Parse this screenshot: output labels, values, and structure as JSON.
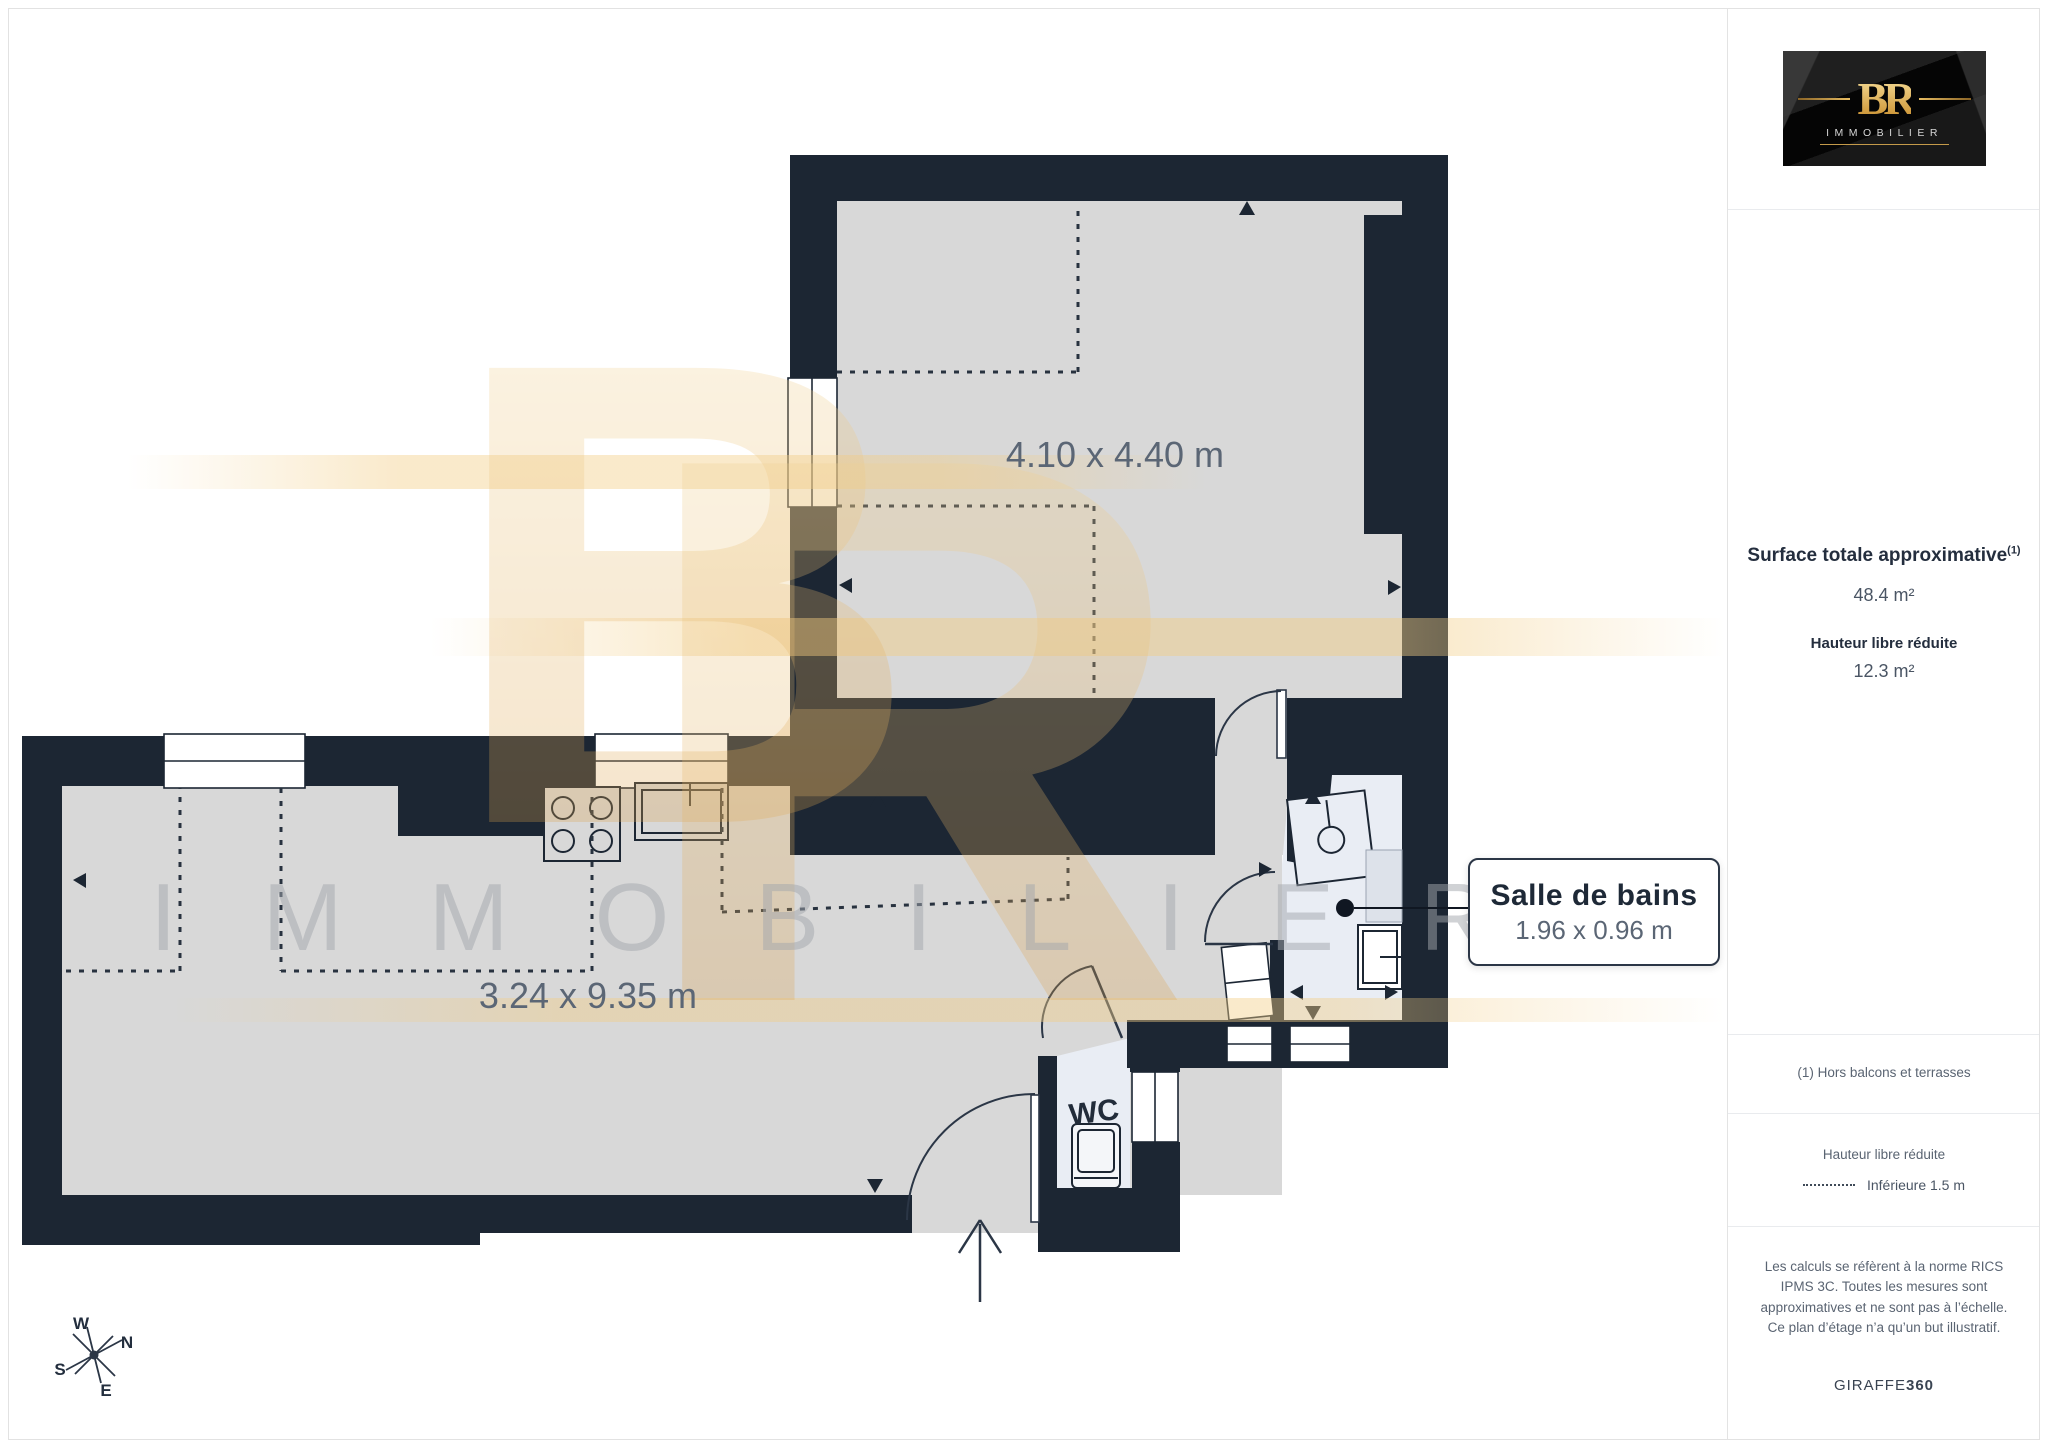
{
  "branding": {
    "logo_monogram": "BR",
    "logo_name": "IMMOBILIER",
    "monogram_b": "B",
    "monogram_r": "R",
    "watermark_text": "IMMOBILIER"
  },
  "plan": {
    "bedroom_label": "4.10 x 4.40 m",
    "living_label": "3.24 x 9.35 m",
    "wc_label": "WC",
    "callout_title": "Salle de bains",
    "callout_dims": "1.96 x 0.96 m",
    "compass": {
      "w": "W",
      "n": "N",
      "s": "S",
      "e": "E"
    }
  },
  "sidebar": {
    "surface_title": "Surface totale approximative",
    "surface_superscript": "(1)",
    "surface_value": "48.4 m²",
    "reduced_height_title": "Hauteur libre réduite",
    "reduced_height_value": "12.3 m²",
    "footnote": "(1) Hors balcons et terrasses",
    "legend_title": "Hauteur libre réduite",
    "legend_item": "Inférieure 1.5 m",
    "disclaimer": "Les calculs se réfèrent à la norme RICS IPMS 3C. Toutes les mesures sont approximatives et ne sont pas à l’échelle. Ce plan d’étage n’a qu’un but illustratif.",
    "footer_brand": "GIRAFFE",
    "footer_brand_bold": "360"
  },
  "colors": {
    "wall": "#1c2633",
    "floor": "#d8d8d8",
    "wet_room_floor": "#e9edf4",
    "gold": "#e8bd6a",
    "text_primary": "#243041",
    "text_muted": "#5b6675"
  }
}
